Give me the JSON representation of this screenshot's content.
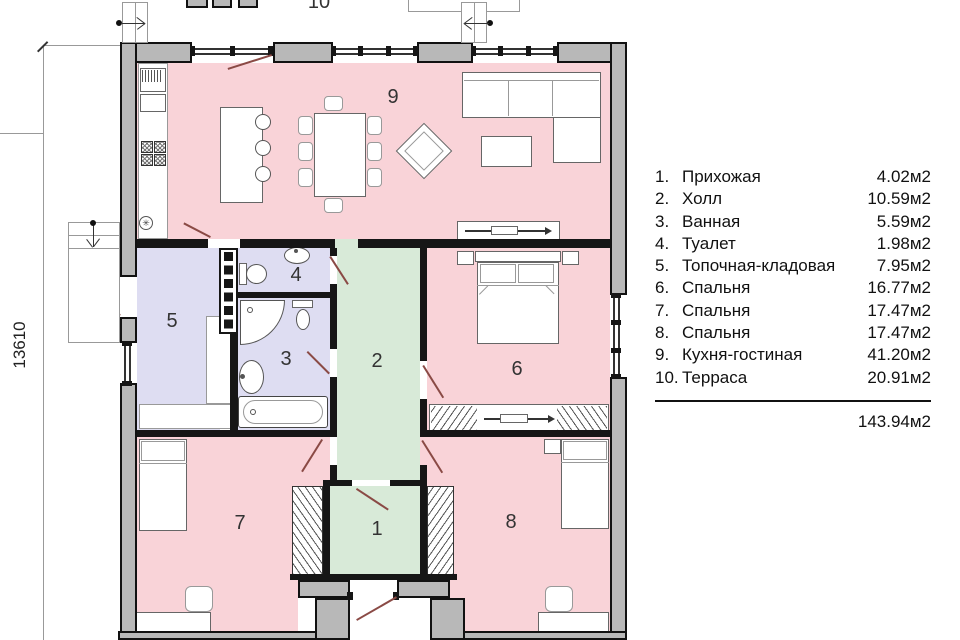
{
  "plan": {
    "dimension_left": "13610",
    "labels": {
      "r1": "1",
      "r2": "2",
      "r3": "3",
      "r4": "4",
      "r5": "5",
      "r6": "6",
      "r7": "7",
      "r8": "8",
      "r9": "9",
      "r10": "10"
    }
  },
  "legend": {
    "items": [
      {
        "num": "1.",
        "name": "Прихожая",
        "area": "4.02м2"
      },
      {
        "num": "2.",
        "name": "Холл",
        "area": "10.59м2"
      },
      {
        "num": "3.",
        "name": "Ванная",
        "area": "5.59м2"
      },
      {
        "num": "4.",
        "name": "Туалет",
        "area": "1.98м2"
      },
      {
        "num": "5.",
        "name": "Топочная-кладовая",
        "area": "7.95м2"
      },
      {
        "num": "6.",
        "name": "Спальня",
        "area": "16.77м2"
      },
      {
        "num": "7.",
        "name": "Спальня",
        "area": "17.47м2"
      },
      {
        "num": "8.",
        "name": "Спальня",
        "area": "17.47м2"
      },
      {
        "num": "9.",
        "name": "Кухня-гостиная",
        "area": "41.20м2"
      },
      {
        "num": "10.",
        "name": "Терраса",
        "area": "20.91м2"
      }
    ],
    "total": "143.94м2"
  },
  "colors": {
    "pink": "#f9d3d8",
    "lavender": "#deddf2",
    "green": "#d8ead8",
    "wall": "#b8b8b8"
  }
}
